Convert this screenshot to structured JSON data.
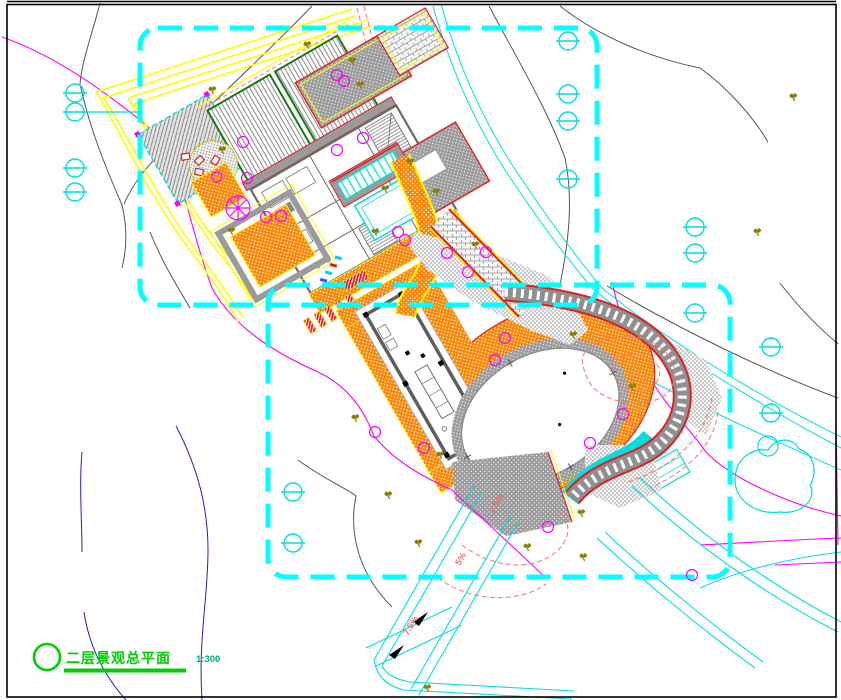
{
  "sheet": {
    "title": "二层景观总平面",
    "scale_label": "1:300"
  },
  "annotations": {
    "slope_labels": [
      "7.5%",
      "5%",
      "7.5%"
    ]
  },
  "palette": {
    "boundary_cyan": "#00ffff",
    "stream_cyan": "#00dede",
    "paving_orange": "#ff8400",
    "contour_magenta": "#ff00ff",
    "contour_gray": "#555555",
    "contour_salmon": "#f08080",
    "water_blue": "#2222bb",
    "road_yellow": "#ffff00",
    "accent_red": "#e02020",
    "planting_olive": "#8a8000",
    "bed_green": "#147814",
    "title_green": "#00d000",
    "scale_green": "#00aa66"
  },
  "symbols": {
    "survey_marker": "circle-with-horizontal-line",
    "tree": "olive-tree-scribble",
    "shrub": "magenta-circle",
    "title_bullet": "green-circle"
  }
}
